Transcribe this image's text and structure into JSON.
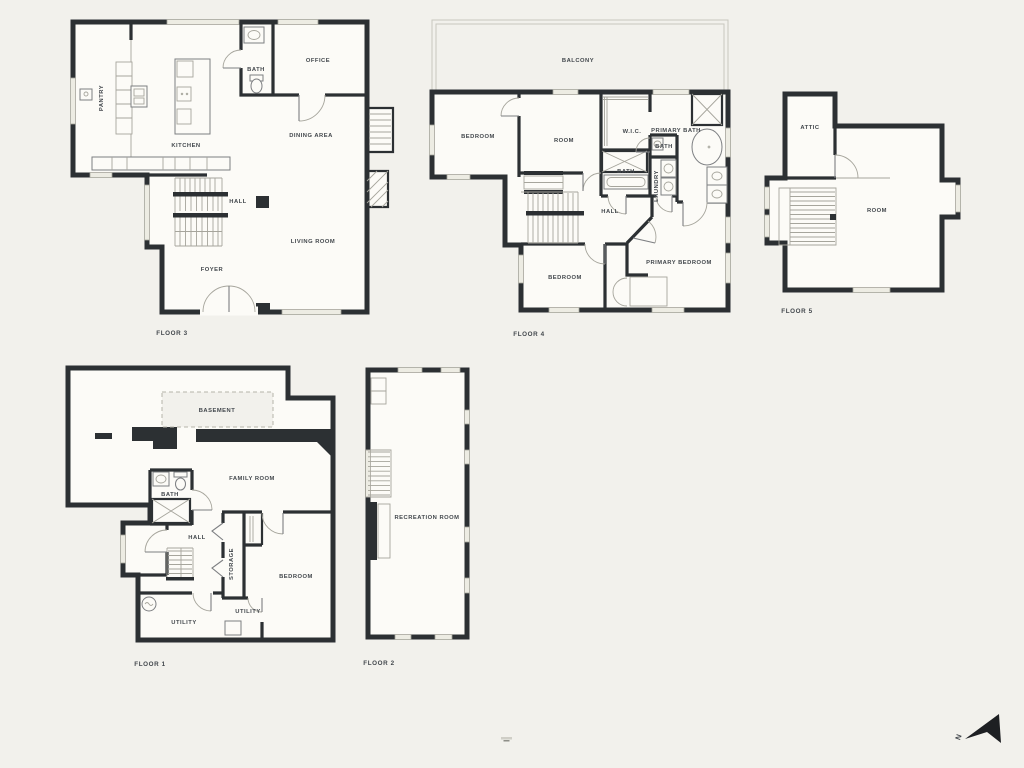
{
  "theme": {
    "background": "#f2f1ec",
    "wall": "#2c3033",
    "floor": "#fcfbf7",
    "line": "#a6a59c",
    "line_dark": "#7d7f82",
    "text": "#42474c",
    "window": "#edece3",
    "dash": "#b5b4aa",
    "balcony_line": "#c8c7be",
    "arrow": "#1d1f22"
  },
  "floors": {
    "floor3": {
      "name": "FLOOR 3",
      "rooms": {
        "pantry": "PANTRY",
        "kitchen": "KITCHEN",
        "bath": "BATH",
        "office": "OFFICE",
        "dining_area": "DINING AREA",
        "hall": "HALL",
        "living_room": "LIVING ROOM",
        "foyer": "FOYER"
      }
    },
    "floor4": {
      "name": "FLOOR 4",
      "rooms": {
        "balcony": "BALCONY",
        "bedroom_left": "BEDROOM",
        "room": "ROOM",
        "wic": "W.I.C.",
        "primary_bath": "PRIMARY BATH",
        "bath_toilet": "BATH",
        "bath_tub": "BATH",
        "laundry": "LAUNDRY",
        "hall": "HALL",
        "bedroom_lower": "BEDROOM",
        "primary_bedroom": "PRIMARY BEDROOM"
      }
    },
    "floor5": {
      "name": "FLOOR 5",
      "rooms": {
        "attic": "ATTIC",
        "room": "ROOM"
      }
    },
    "floor1": {
      "name": "FLOOR 1",
      "rooms": {
        "basement": "BASEMENT",
        "family_room": "FAMILY ROOM",
        "bath": "BATH",
        "hall": "HALL",
        "storage": "STORAGE",
        "bedroom": "BEDROOM",
        "utility_left": "UTILITY",
        "utility_right": "UTILITY"
      }
    },
    "floor2": {
      "name": "FLOOR 2",
      "rooms": {
        "recreation_room": "RECREATION ROOM"
      }
    }
  },
  "compass": {
    "north_label": "N"
  }
}
